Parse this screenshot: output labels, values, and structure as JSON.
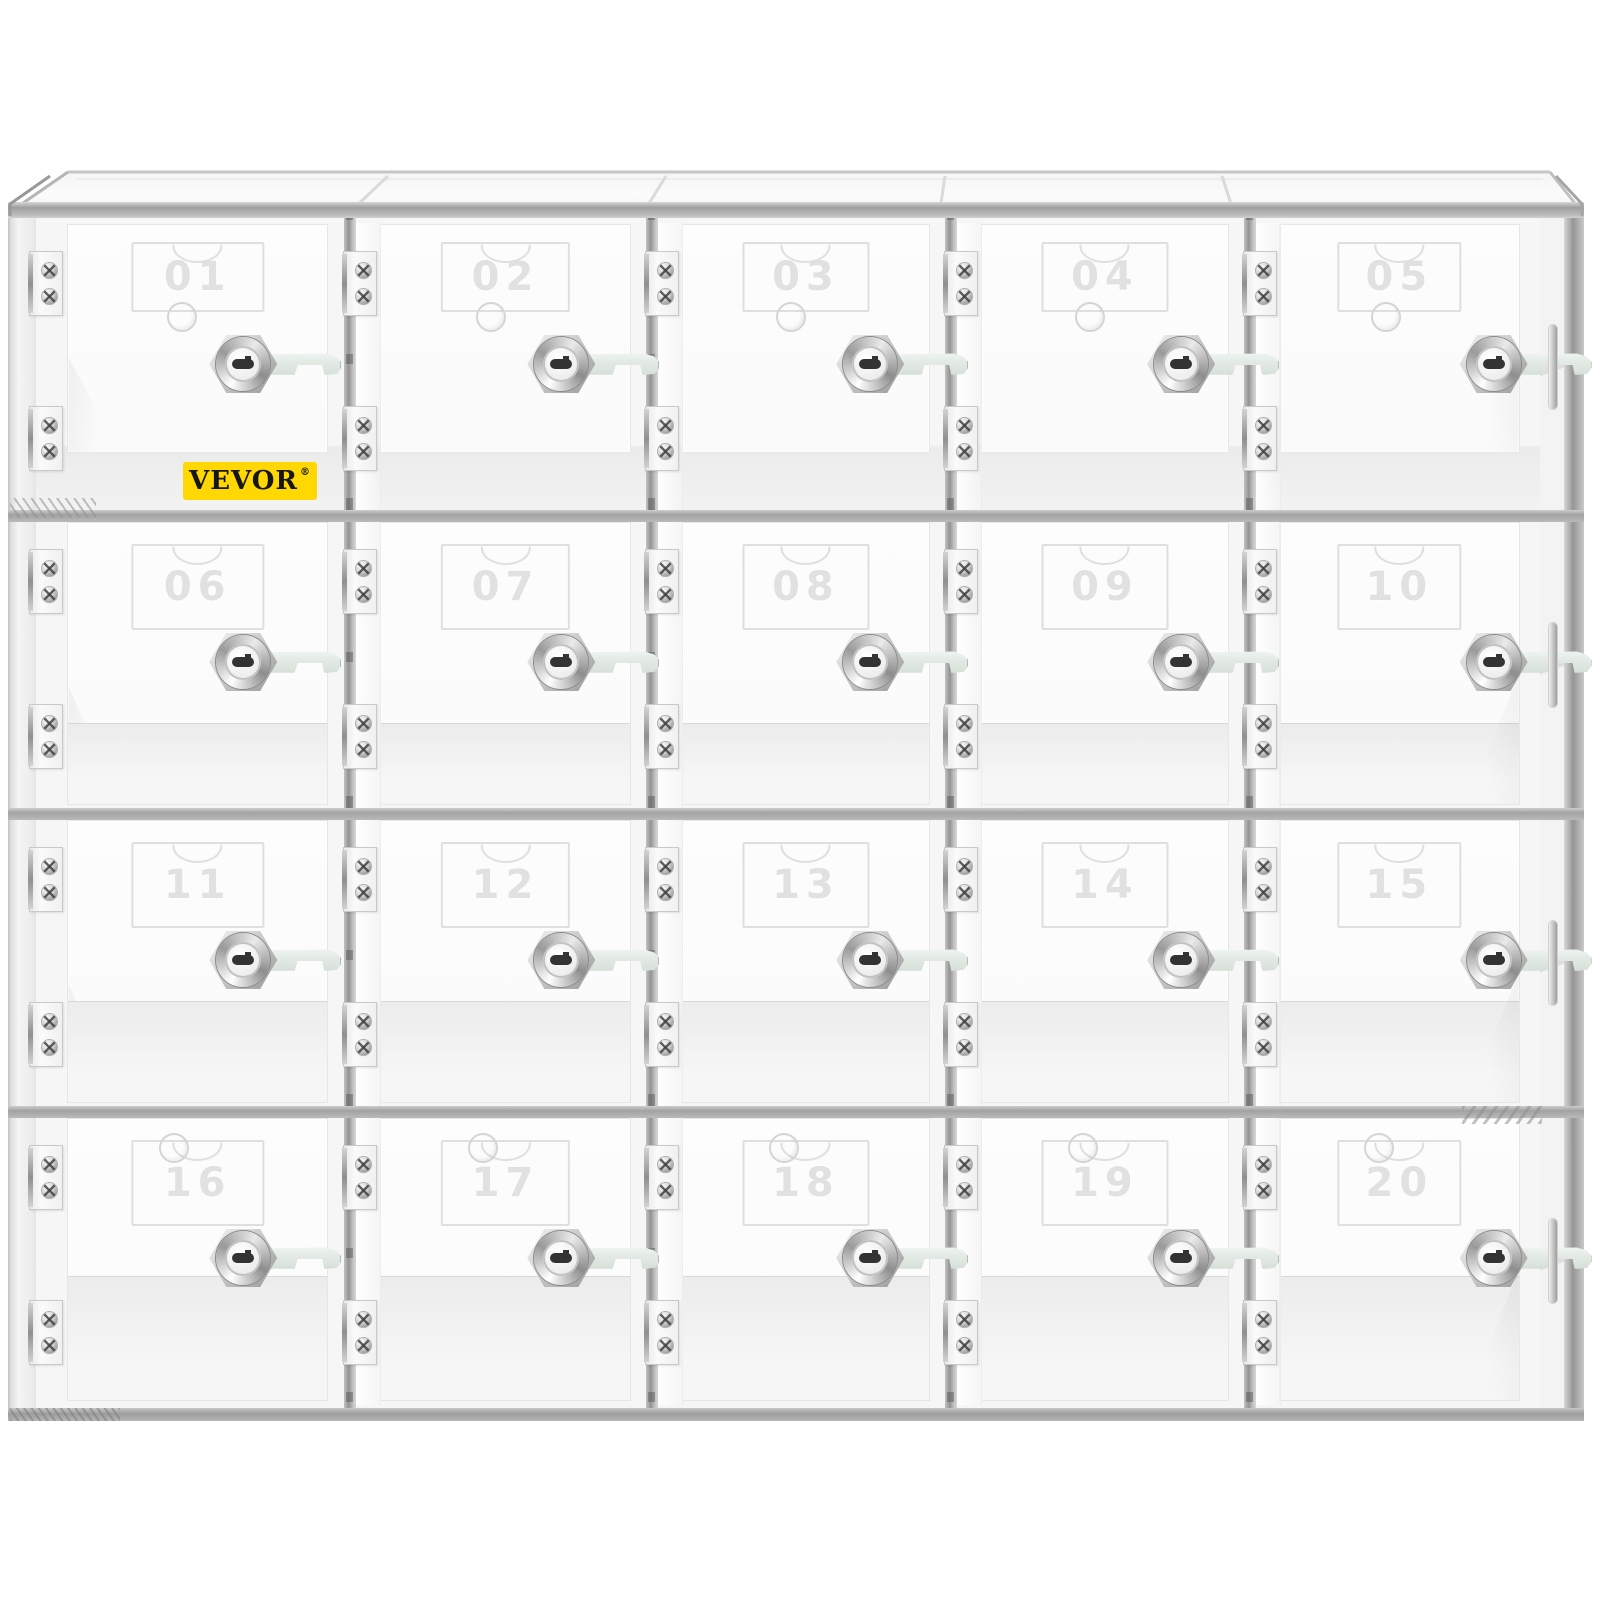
{
  "brand": {
    "name": "VEVOR",
    "registered": "®",
    "badge_bg": "#FFD702",
    "badge_text": "#161616"
  },
  "grid": {
    "rows": 4,
    "columns": 5,
    "total_lockers": 20
  },
  "lockers": [
    {
      "number": "01"
    },
    {
      "number": "02"
    },
    {
      "number": "03"
    },
    {
      "number": "04"
    },
    {
      "number": "05"
    },
    {
      "number": "06"
    },
    {
      "number": "07"
    },
    {
      "number": "08"
    },
    {
      "number": "09"
    },
    {
      "number": "10"
    },
    {
      "number": "11"
    },
    {
      "number": "12"
    },
    {
      "number": "13"
    },
    {
      "number": "14"
    },
    {
      "number": "15"
    },
    {
      "number": "16"
    },
    {
      "number": "17"
    },
    {
      "number": "18"
    },
    {
      "number": "19"
    },
    {
      "number": "20"
    }
  ],
  "colors": {
    "background": "#ffffff",
    "frame_gray": "#a2a2a2",
    "divider_gray": "#939393",
    "metal_gray": "#c9c9c9",
    "latch_tint": "#d2dcd4",
    "door_white": "#fdfdfd",
    "number_embossed": "rgba(135,135,135,0.25)"
  }
}
